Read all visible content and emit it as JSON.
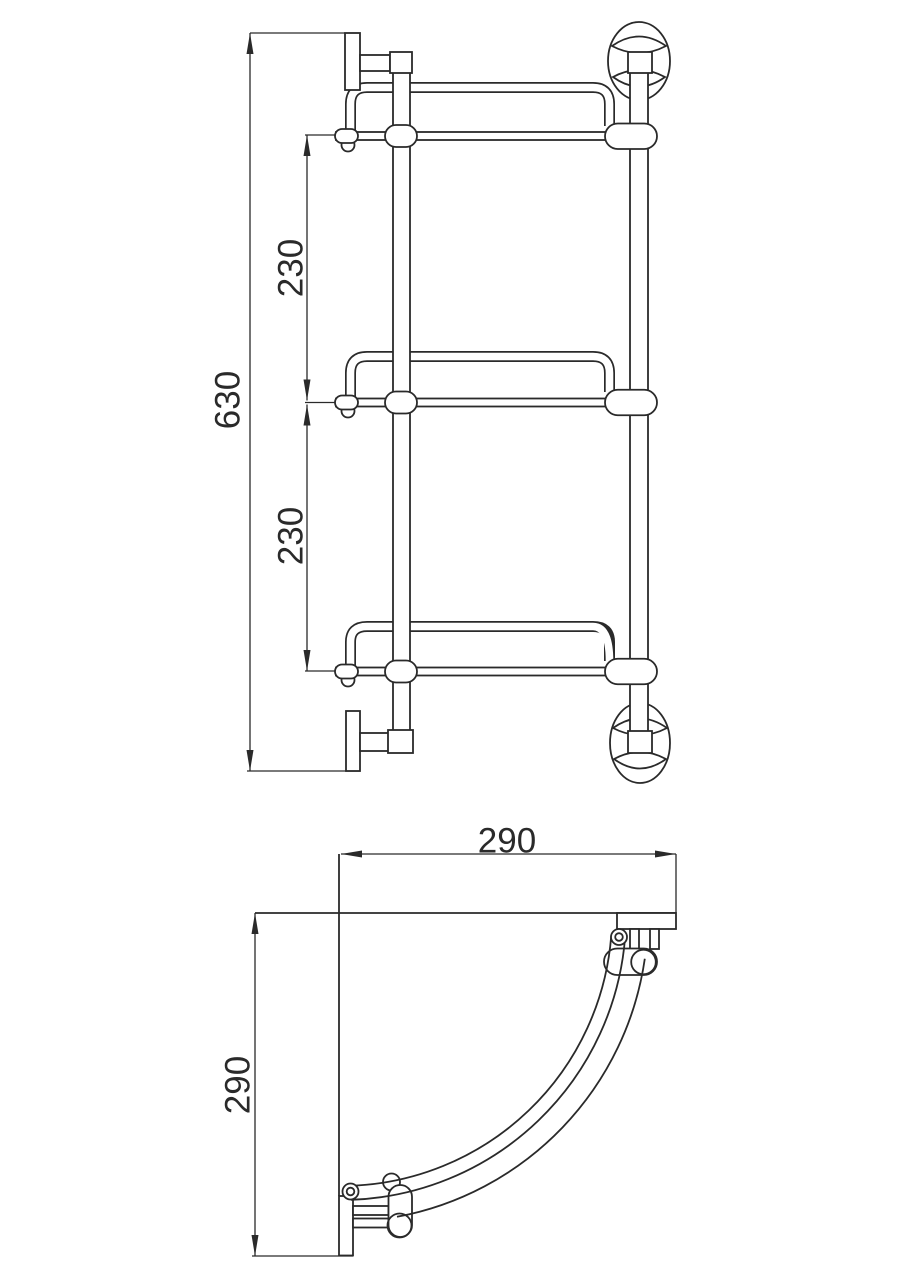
{
  "page": {
    "title": "Corner shelf technical dimension drawing",
    "background": "#ffffff"
  },
  "colors": {
    "line": "#2a2a2a"
  },
  "views": {
    "elevation": {
      "name": "front-elevation",
      "description": "Three-tier wall shelf, front view",
      "dims": {
        "total_height": "630",
        "upper_gap": "230",
        "lower_gap": "230"
      }
    },
    "plan": {
      "name": "top-plan",
      "description": "Quarter-round corner shelf, top view",
      "dims": {
        "width": "290",
        "depth": "290"
      }
    }
  }
}
